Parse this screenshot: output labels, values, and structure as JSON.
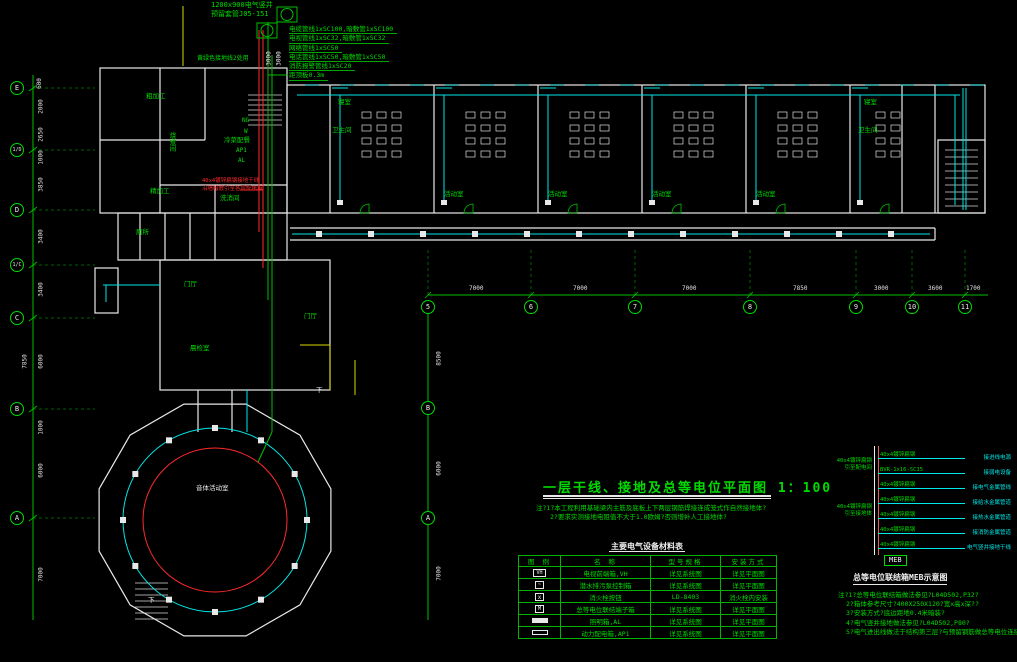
{
  "colors": {
    "green": "#00dc00",
    "cyan": "#00e8e8",
    "red": "#ff2a2a",
    "yellow": "#d8d800",
    "white": "#f0f0f0"
  },
  "header_block": {
    "shaft_line1": "1200x900电气竖井",
    "shaft_line2": "预留套管J05-151",
    "spec_lines": [
      "电缆管线1xSC100,暗敷管1xSC100",
      "电视管线1xSC32,暗敷管1xSC32",
      "网络管线1xSC50",
      "电话管线1xSC50,暗敷管1xSC50",
      "消防报警管线1xSC20",
      "距顶板0.3m"
    ],
    "side_note": "黄绿色接地线2处用",
    "riser_dims": [
      "3000",
      "3000"
    ]
  },
  "plan": {
    "labels": [
      {
        "text": "粗加工",
        "x": 146,
        "y": 92,
        "color": "g"
      },
      {
        "text": "烧煮间",
        "x": 168,
        "y": 132,
        "color": "g",
        "vertical": true
      },
      {
        "text": "冷菜配餐",
        "x": 224,
        "y": 136,
        "color": "g"
      },
      {
        "text": "精加工",
        "x": 150,
        "y": 187,
        "color": "g"
      },
      {
        "text": "洗消间",
        "x": 220,
        "y": 194,
        "color": "g"
      },
      {
        "text": "厕所",
        "x": 136,
        "y": 228,
        "color": "g"
      },
      {
        "text": "门厅",
        "x": 184,
        "y": 280,
        "color": "g"
      },
      {
        "text": "门厅",
        "x": 304,
        "y": 312,
        "color": "g"
      },
      {
        "text": "晨检室",
        "x": 190,
        "y": 344,
        "color": "g"
      },
      {
        "text": "寝室",
        "x": 338,
        "y": 98,
        "color": "g"
      },
      {
        "text": "卫生间",
        "x": 332,
        "y": 126,
        "color": "g"
      },
      {
        "text": "活动室",
        "x": 444,
        "y": 190,
        "color": "g"
      },
      {
        "text": "活动室",
        "x": 548,
        "y": 190,
        "color": "g"
      },
      {
        "text": "活动室",
        "x": 652,
        "y": 190,
        "color": "g"
      },
      {
        "text": "活动室",
        "x": 756,
        "y": 190,
        "color": "g"
      },
      {
        "text": "寝室",
        "x": 864,
        "y": 98,
        "color": "g"
      },
      {
        "text": "卫生间",
        "x": 858,
        "y": 126,
        "color": "g"
      },
      {
        "text": "音体活动室",
        "x": 196,
        "y": 484,
        "color": "w"
      },
      {
        "text": "下",
        "x": 316,
        "y": 386,
        "color": "w"
      },
      {
        "text": "下",
        "x": 148,
        "y": 596,
        "color": "w"
      }
    ],
    "riser_labels": [
      {
        "text": "NG",
        "x": 242,
        "y": 117
      },
      {
        "text": "W",
        "x": 244,
        "y": 128
      },
      {
        "text": "AP1",
        "x": 236,
        "y": 147
      },
      {
        "text": "AL",
        "x": 238,
        "y": 157
      }
    ],
    "red_note": [
      "40x4镀锌扁钢接地干线",
      "沿墙暗敷引至各层配电箱"
    ]
  },
  "axes": {
    "left_bubbles": [
      {
        "label": "E",
        "y": 88
      },
      {
        "label": "1/D",
        "y": 150
      },
      {
        "label": "D",
        "y": 210
      },
      {
        "label": "1/C",
        "y": 265
      },
      {
        "label": "C",
        "y": 318
      },
      {
        "label": "B",
        "y": 409
      },
      {
        "label": "A",
        "y": 518
      }
    ],
    "left_dims": [
      {
        "label": "600",
        "y": 80
      },
      {
        "label": "2000",
        "y": 103
      },
      {
        "label": "2650",
        "y": 131
      },
      {
        "label": "1000",
        "y": 154
      },
      {
        "label": "3850",
        "y": 181
      },
      {
        "label": "3400",
        "y": 233
      },
      {
        "label": "3400",
        "y": 286
      },
      {
        "label": "6000",
        "y": 358
      },
      {
        "label": "1000",
        "y": 424
      },
      {
        "label": "6000",
        "y": 467
      },
      {
        "label": "7000",
        "y": 571
      }
    ],
    "outer_dims": [
      {
        "label": "7850",
        "y": 358
      }
    ],
    "bottom_bubbles": [
      {
        "label": "5",
        "x": 428
      },
      {
        "label": "6",
        "x": 531
      },
      {
        "label": "7",
        "x": 635
      },
      {
        "label": "8",
        "x": 750
      },
      {
        "label": "9",
        "x": 856
      },
      {
        "label": "10",
        "x": 912
      },
      {
        "label": "11",
        "x": 965
      }
    ],
    "bottom_dims": [
      {
        "label": "7000",
        "x": 479
      },
      {
        "label": "7000",
        "x": 583
      },
      {
        "label": "7000",
        "x": 692
      },
      {
        "label": "7850",
        "x": 803
      },
      {
        "label": "3000",
        "x": 884
      },
      {
        "label": "3600",
        "x": 938
      },
      {
        "label": "1700",
        "x": 976
      }
    ],
    "inner_bubbles": [
      {
        "label": "B",
        "y": 408
      },
      {
        "label": "A",
        "y": 518
      }
    ],
    "inner_dims": [
      {
        "label": "8500",
        "y": 355
      },
      {
        "label": "6000",
        "y": 465
      },
      {
        "label": "7000",
        "y": 570
      }
    ]
  },
  "title_block": {
    "title": "一层干线、接地及总等电位平面图 1：100",
    "notes": [
      "注?1?本工程利用基础梁内主筋及底板上下两层钢筋焊接连成笼式作自然接地体?",
      "2?要求实测接地电阻值不大于1.0欧姆?否则增补人工接地体?"
    ]
  },
  "equipment_table": {
    "title": "主要电气设备材料表",
    "headers": [
      "图 例",
      "名 称",
      "型号规格",
      "安装方式"
    ],
    "rows": [
      {
        "symbol": "vh-box",
        "name": "电视前端箱,VH",
        "model": "详见系统图",
        "install": "详见平面图"
      },
      {
        "symbol": "pump-box",
        "name": "潜水排污泵控制箱",
        "model": "详见系统图",
        "install": "详见平面图"
      },
      {
        "symbol": "hydrant-button",
        "name": "消火栓按钮",
        "model": "LD-8403",
        "install": "消火栓内安装"
      },
      {
        "symbol": "meb-box",
        "name": "总等电位联结端子箱",
        "model": "详见系统图",
        "install": "详见平面图"
      },
      {
        "symbol": "lighting-box",
        "name": "照明箱,AL",
        "model": "详见系统图",
        "install": "详见平面图"
      },
      {
        "symbol": "power-box",
        "name": "动力配电箱,AP1",
        "model": "详见系统图",
        "install": "详见平面图"
      }
    ]
  },
  "meb_diagram": {
    "caption": "总等电位联结箱MEB示意图",
    "box_label": "MEB",
    "bus_top_label": [
      "40x4镀锌扁钢",
      "引至配电间"
    ],
    "bus_bottom_label": [
      "40x4镀锌扁钢",
      "引至接地体"
    ],
    "rows": [
      {
        "left": "40x4镀锌扁钢",
        "right": "接进线电源"
      },
      {
        "left": "BVR-1x16-SC15",
        "right": "接弱电设备"
      },
      {
        "left": "40x4镀锌扁钢",
        "right": "接电气金属管线"
      },
      {
        "left": "40x4镀锌扁钢",
        "right": "接给水金属管道"
      },
      {
        "left": "40x4镀锌扁钢",
        "right": "接热水金属管道"
      },
      {
        "left": "40x4镀锌扁钢",
        "right": "接消防金属管道"
      },
      {
        "left": "40x4镀锌扁钢",
        "right": "电气竖井接地干线"
      }
    ],
    "notes": [
      "注?1?总等电位联结箱做法参见?L04D502,P32?",
      "2?箱体参考尺寸?400X250X120?宽x高x深??",
      "3?安装方式?底边距地0.4米暗装?",
      "4?电气竖井接地做法参见?L04D502,P80?",
      "5?电气进出线做法于结构第三层?与预留钢筋做总等电位连接?"
    ]
  }
}
